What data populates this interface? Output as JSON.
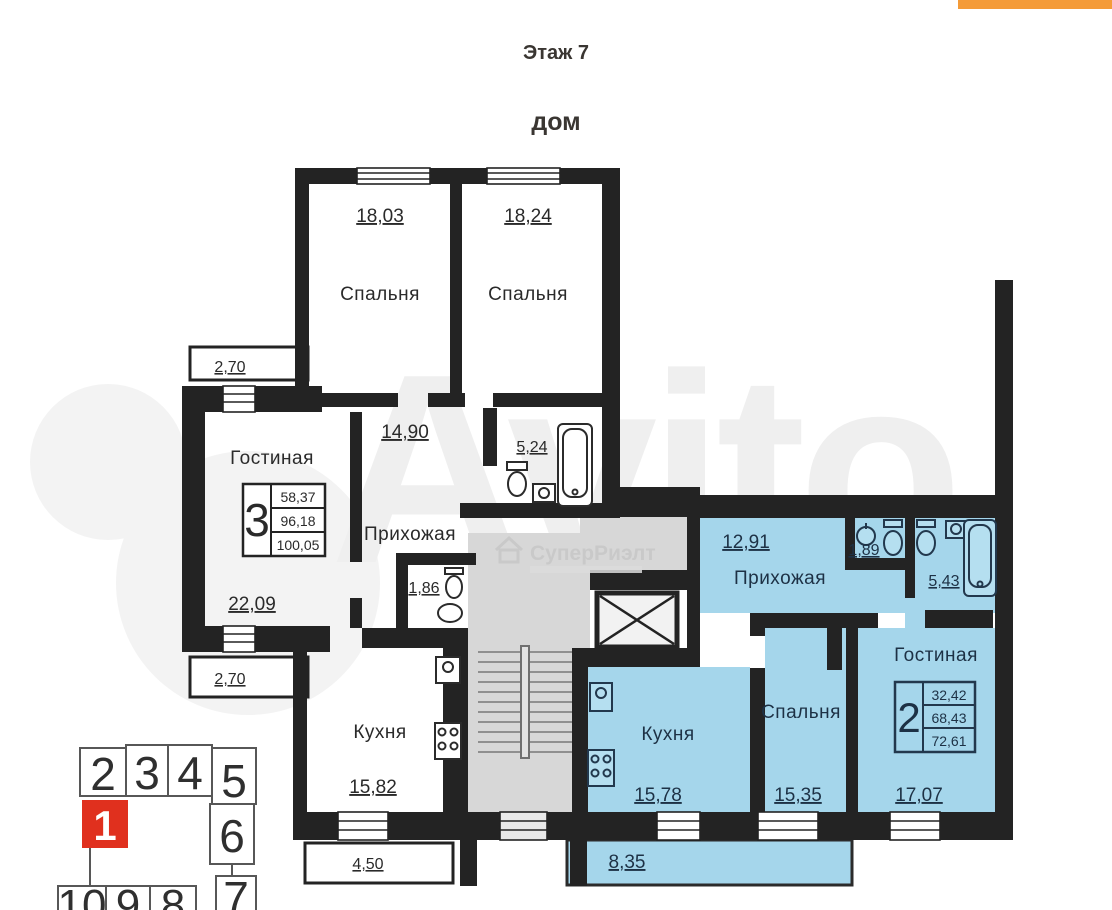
{
  "header": {
    "floor": "Этаж 7",
    "building": "дом"
  },
  "watermark": {
    "brand": "Avito",
    "agency": "СуперРиэлт"
  },
  "colors": {
    "wall": "#232323",
    "apartment_highlight": "#a5d6eb",
    "stairs": "#d7d7d7",
    "accent_red": "#e0301e",
    "accent_orange": "#f49b38"
  },
  "plan": {
    "left": {
      "type": "3",
      "areas": {
        "a1": "58,37",
        "a2": "96,18",
        "a3": "100,05"
      },
      "bedroom1": {
        "name": "Спальня",
        "area": "18,03"
      },
      "bedroom2": {
        "name": "Спальня",
        "area": "18,24"
      },
      "living": {
        "name": "Гостиная",
        "area": "22,09"
      },
      "hallway": {
        "name": "Прихожая",
        "area": "14,90"
      },
      "bathroom": {
        "area": "5,24"
      },
      "wc": {
        "area": "1,86"
      },
      "kitchen": {
        "name": "Кухня",
        "area": "15,82"
      },
      "balcony_top": {
        "area": "2,70"
      },
      "balcony_bottom": {
        "area": "2,70"
      },
      "balcony_kitchen": {
        "area": "4,50"
      }
    },
    "right": {
      "type": "2",
      "areas": {
        "a1": "32,42",
        "a2": "68,43",
        "a3": "72,61"
      },
      "hallway": {
        "name": "Прихожая",
        "area": "12,91"
      },
      "wc": {
        "area": "1,89"
      },
      "bathroom": {
        "area": "5,43"
      },
      "living": {
        "name": "Гостиная",
        "area": "17,07"
      },
      "bedroom": {
        "name": "Спальня",
        "area": "15,35"
      },
      "kitchen": {
        "name": "Кухня",
        "area": "15,78"
      },
      "balcony": {
        "area": "8,35"
      }
    },
    "minimap": {
      "s1": "1",
      "s2": "2",
      "s3": "3",
      "s4": "4",
      "s5": "5",
      "s6": "6",
      "s7": "7",
      "s8": "8",
      "s9": "9",
      "s10": "10"
    }
  }
}
